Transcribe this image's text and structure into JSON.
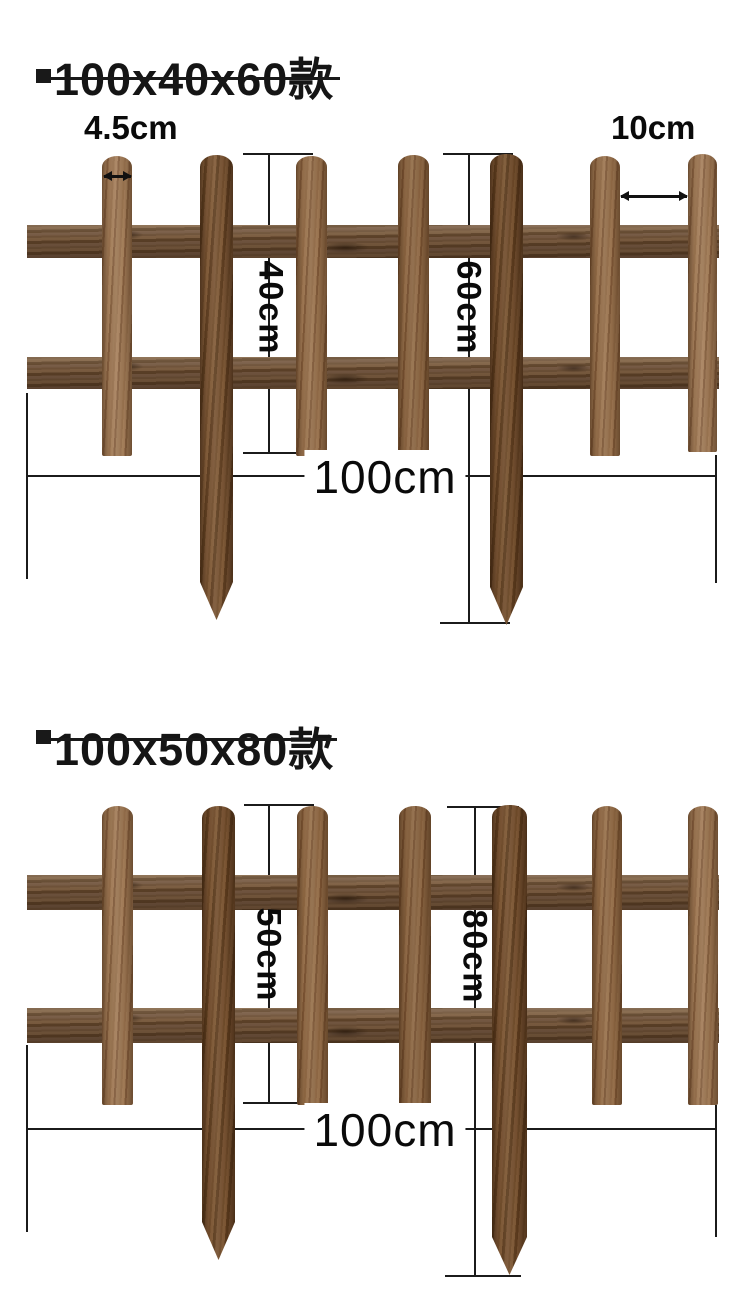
{
  "figures": [
    {
      "title": "100x40x60款",
      "labels": {
        "picket_width": "4.5cm",
        "gap_width": "10cm",
        "picket_height": "40cm",
        "stake_height": "60cm",
        "total_width": "100cm"
      },
      "structure": {
        "picket_count": 7,
        "rail_count": 2,
        "staked_picket_positions": [
          2,
          5
        ]
      }
    },
    {
      "title": "100x50x80款",
      "labels": {
        "picket_height": "50cm",
        "stake_height": "80cm",
        "total_width": "100cm"
      },
      "structure": {
        "picket_count": 7,
        "rail_count": 2,
        "staked_picket_positions": [
          2,
          5
        ]
      }
    }
  ],
  "colors": {
    "background": "#ffffff",
    "dimension_line": "#1b1b1b",
    "label_text": "#0a0a0a",
    "wood_picket_light": "#9a7450",
    "wood_picket_dark": "#7b5535",
    "wood_rail": "#6c5037",
    "wood_stake": "#6f4c2c"
  }
}
